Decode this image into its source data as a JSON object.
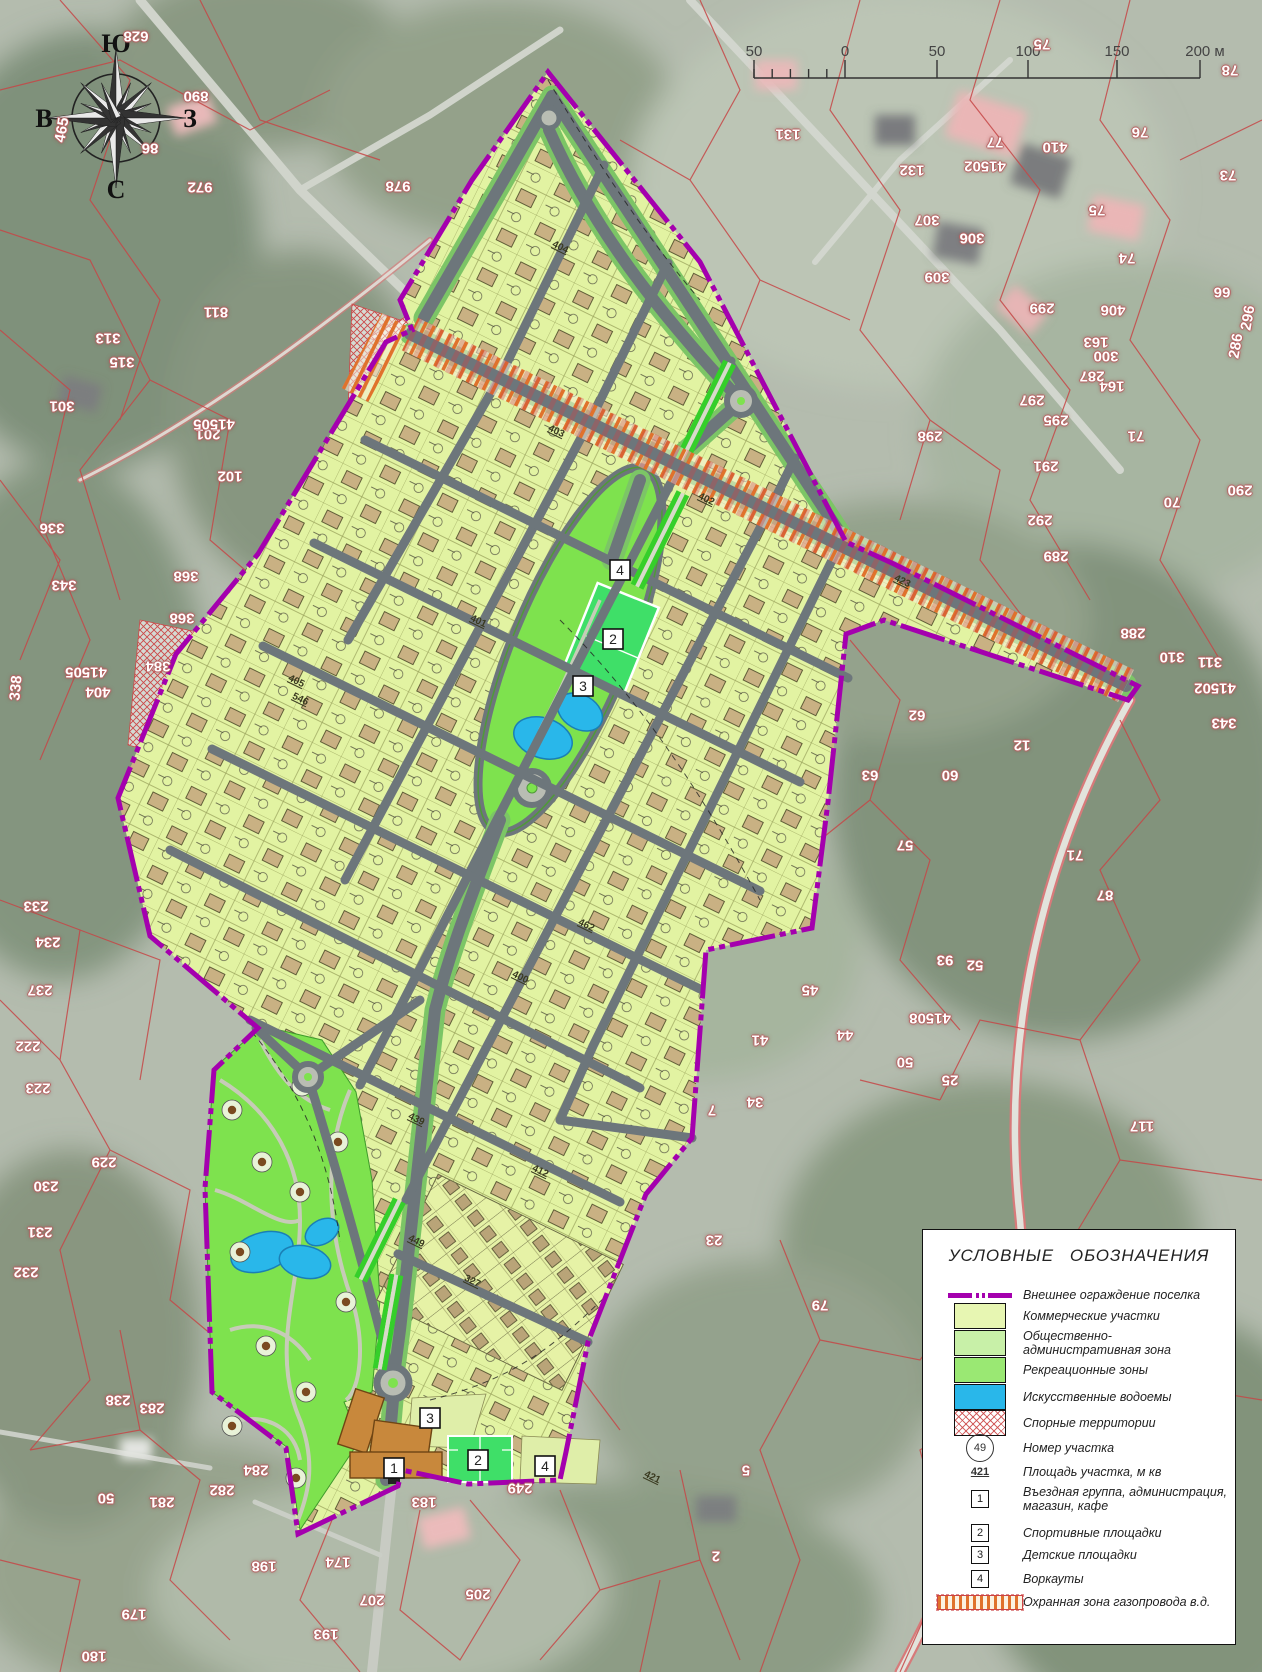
{
  "colors": {
    "boundary_purple": "#a400ae",
    "lot_fill": "#e2f3a2",
    "road_gray": "#6d767b",
    "verge_green": "#7cc566",
    "recreation_green": "#7ee24e",
    "sports_green": "#3fdf68",
    "pond_blue": "#29b7ea",
    "house_tan": "#c9b183",
    "gas_hatch_orange": "#e0722c",
    "disputed_red": "#cc4949",
    "cadastral_red": "#c64747",
    "legend_commercial": "#e7f6b2",
    "legend_admin": "#c8f0a8",
    "legend_recreation": "#9ae873",
    "legend_water": "#29b7ea",
    "admin_building_orange": "#c8883c"
  },
  "compass": {
    "top": "Ю",
    "left": "В",
    "right": "З",
    "bottom": "С"
  },
  "scale_bar": {
    "labels": [
      "50",
      "0",
      "50",
      "100",
      "150",
      "200 м"
    ]
  },
  "legend": {
    "title": "УСЛОВНЫЕ ОБОЗНАЧЕНИЯ",
    "items": [
      {
        "label": "Внешнее ограждение поселка"
      },
      {
        "label": "Коммерческие участки"
      },
      {
        "label": "Общественно-административная зона"
      },
      {
        "label": "Рекреационные зоны"
      },
      {
        "label": "Искусственные водоемы"
      },
      {
        "label": "Спорные территории"
      },
      {
        "label": "Номер участка",
        "symbol": "49"
      },
      {
        "label": "Площадь участка, м кв",
        "symbol": "421"
      },
      {
        "label": "Въездная группа, администрация, магазин, кафе",
        "symbol": "1"
      },
      {
        "label": "Спортивные площадки",
        "symbol": "2"
      },
      {
        "label": "Детские площадки",
        "symbol": "3"
      },
      {
        "label": "Воркауты",
        "symbol": "4"
      },
      {
        "label": "Охранная зона газопровода в.д."
      }
    ]
  },
  "map_markers": [
    {
      "n": "4",
      "x": 620,
      "y": 570
    },
    {
      "n": "2",
      "x": 613,
      "y": 639
    },
    {
      "n": "3",
      "x": 583,
      "y": 686
    },
    {
      "n": "3",
      "x": 430,
      "y": 1418
    },
    {
      "n": "1",
      "x": 394,
      "y": 1468
    },
    {
      "n": "2",
      "x": 478,
      "y": 1460
    },
    {
      "n": "4",
      "x": 545,
      "y": 1466
    }
  ],
  "plan_area_labels": [
    {
      "t": "404",
      "x": 560,
      "y": 248
    },
    {
      "t": "403",
      "x": 556,
      "y": 432
    },
    {
      "t": "401",
      "x": 478,
      "y": 622
    },
    {
      "t": "402",
      "x": 706,
      "y": 500
    },
    {
      "t": "400",
      "x": 520,
      "y": 978
    },
    {
      "t": "405",
      "x": 296,
      "y": 682
    },
    {
      "t": "423",
      "x": 902,
      "y": 582
    },
    {
      "t": "449",
      "x": 416,
      "y": 1242
    },
    {
      "t": "327",
      "x": 472,
      "y": 1282
    },
    {
      "t": "439",
      "x": 416,
      "y": 1120
    },
    {
      "t": "412",
      "x": 540,
      "y": 1172
    },
    {
      "t": "421",
      "x": 652,
      "y": 1478
    },
    {
      "t": "546",
      "x": 300,
      "y": 700
    },
    {
      "t": "462",
      "x": 586,
      "y": 926
    }
  ],
  "cadastral_labels": [
    {
      "t": "628",
      "x": 136,
      "y": 36
    },
    {
      "t": "465",
      "x": 62,
      "y": 130,
      "r": -80
    },
    {
      "t": "890",
      "x": 196,
      "y": 96
    },
    {
      "t": "86",
      "x": 150,
      "y": 148
    },
    {
      "t": "972",
      "x": 200,
      "y": 187
    },
    {
      "t": "978",
      "x": 398,
      "y": 186
    },
    {
      "t": "811",
      "x": 216,
      "y": 312
    },
    {
      "t": "313",
      "x": 108,
      "y": 338
    },
    {
      "t": "315",
      "x": 122,
      "y": 362
    },
    {
      "t": "301",
      "x": 62,
      "y": 406
    },
    {
      "t": "201",
      "x": 208,
      "y": 434
    },
    {
      "t": "41505",
      "x": 214,
      "y": 424
    },
    {
      "t": "102",
      "x": 230,
      "y": 476
    },
    {
      "t": "336",
      "x": 52,
      "y": 528
    },
    {
      "t": "343",
      "x": 64,
      "y": 585
    },
    {
      "t": "368",
      "x": 186,
      "y": 576
    },
    {
      "t": "368",
      "x": 182,
      "y": 618
    },
    {
      "t": "384",
      "x": 158,
      "y": 666
    },
    {
      "t": "338",
      "x": 16,
      "y": 688,
      "r": -85
    },
    {
      "t": "404",
      "x": 98,
      "y": 692
    },
    {
      "t": "41505",
      "x": 86,
      "y": 672
    },
    {
      "t": "233",
      "x": 36,
      "y": 906
    },
    {
      "t": "234",
      "x": 48,
      "y": 942
    },
    {
      "t": "237",
      "x": 40,
      "y": 990
    },
    {
      "t": "222",
      "x": 28,
      "y": 1046
    },
    {
      "t": "223",
      "x": 38,
      "y": 1088
    },
    {
      "t": "229",
      "x": 104,
      "y": 1162
    },
    {
      "t": "230",
      "x": 46,
      "y": 1186
    },
    {
      "t": "231",
      "x": 40,
      "y": 1232
    },
    {
      "t": "232",
      "x": 26,
      "y": 1272
    },
    {
      "t": "238",
      "x": 118,
      "y": 1400
    },
    {
      "t": "283",
      "x": 152,
      "y": 1408
    },
    {
      "t": "50",
      "x": 106,
      "y": 1498
    },
    {
      "t": "281",
      "x": 162,
      "y": 1502
    },
    {
      "t": "282",
      "x": 222,
      "y": 1490
    },
    {
      "t": "284",
      "x": 256,
      "y": 1470
    },
    {
      "t": "183",
      "x": 424,
      "y": 1502
    },
    {
      "t": "249",
      "x": 520,
      "y": 1488
    },
    {
      "t": "198",
      "x": 264,
      "y": 1566
    },
    {
      "t": "174",
      "x": 338,
      "y": 1562
    },
    {
      "t": "179",
      "x": 134,
      "y": 1614
    },
    {
      "t": "180",
      "x": 94,
      "y": 1656
    },
    {
      "t": "193",
      "x": 326,
      "y": 1634
    },
    {
      "t": "205",
      "x": 478,
      "y": 1594
    },
    {
      "t": "207",
      "x": 372,
      "y": 1600
    },
    {
      "t": "76",
      "x": 1140,
      "y": 132
    },
    {
      "t": "77",
      "x": 995,
      "y": 142
    },
    {
      "t": "41502",
      "x": 985,
      "y": 166
    },
    {
      "t": "410",
      "x": 1055,
      "y": 147
    },
    {
      "t": "73",
      "x": 1228,
      "y": 175
    },
    {
      "t": "75",
      "x": 1097,
      "y": 210
    },
    {
      "t": "74",
      "x": 1127,
      "y": 258
    },
    {
      "t": "299",
      "x": 1042,
      "y": 308
    },
    {
      "t": "406",
      "x": 1113,
      "y": 310
    },
    {
      "t": "66",
      "x": 1222,
      "y": 292
    },
    {
      "t": "307",
      "x": 927,
      "y": 220
    },
    {
      "t": "306",
      "x": 972,
      "y": 238
    },
    {
      "t": "309",
      "x": 937,
      "y": 277
    },
    {
      "t": "131",
      "x": 788,
      "y": 134
    },
    {
      "t": "132",
      "x": 912,
      "y": 170
    },
    {
      "t": "78",
      "x": 1230,
      "y": 70
    },
    {
      "t": "75",
      "x": 1042,
      "y": 44
    },
    {
      "t": "163",
      "x": 1096,
      "y": 342
    },
    {
      "t": "164",
      "x": 1112,
      "y": 386
    },
    {
      "t": "295",
      "x": 1056,
      "y": 420
    },
    {
      "t": "297",
      "x": 1032,
      "y": 400
    },
    {
      "t": "287",
      "x": 1092,
      "y": 376
    },
    {
      "t": "300",
      "x": 1106,
      "y": 356
    },
    {
      "t": "286",
      "x": 1236,
      "y": 346,
      "r": -80
    },
    {
      "t": "296",
      "x": 1248,
      "y": 318,
      "r": -80
    },
    {
      "t": "298",
      "x": 930,
      "y": 436
    },
    {
      "t": "291",
      "x": 1046,
      "y": 466
    },
    {
      "t": "71",
      "x": 1136,
      "y": 436
    },
    {
      "t": "70",
      "x": 1172,
      "y": 502
    },
    {
      "t": "292",
      "x": 1040,
      "y": 520
    },
    {
      "t": "289",
      "x": 1056,
      "y": 556
    },
    {
      "t": "290",
      "x": 1240,
      "y": 490
    },
    {
      "t": "288",
      "x": 1133,
      "y": 633
    },
    {
      "t": "310",
      "x": 1172,
      "y": 657
    },
    {
      "t": "311",
      "x": 1210,
      "y": 662
    },
    {
      "t": "41502",
      "x": 1215,
      "y": 688
    },
    {
      "t": "343",
      "x": 1224,
      "y": 723
    },
    {
      "t": "12",
      "x": 1022,
      "y": 745
    },
    {
      "t": "62",
      "x": 917,
      "y": 715
    },
    {
      "t": "63",
      "x": 870,
      "y": 775
    },
    {
      "t": "60",
      "x": 950,
      "y": 775
    },
    {
      "t": "57",
      "x": 905,
      "y": 845
    },
    {
      "t": "71",
      "x": 1075,
      "y": 855
    },
    {
      "t": "87",
      "x": 1105,
      "y": 895
    },
    {
      "t": "93",
      "x": 945,
      "y": 960
    },
    {
      "t": "52",
      "x": 975,
      "y": 965
    },
    {
      "t": "45",
      "x": 810,
      "y": 990
    },
    {
      "t": "41508",
      "x": 930,
      "y": 1018
    },
    {
      "t": "34",
      "x": 755,
      "y": 1102
    },
    {
      "t": "44",
      "x": 845,
      "y": 1035
    },
    {
      "t": "41",
      "x": 760,
      "y": 1040
    },
    {
      "t": "50",
      "x": 905,
      "y": 1062
    },
    {
      "t": "25",
      "x": 950,
      "y": 1080
    },
    {
      "t": "7",
      "x": 712,
      "y": 1110
    },
    {
      "t": "117",
      "x": 1142,
      "y": 1126
    },
    {
      "t": "23",
      "x": 714,
      "y": 1240
    },
    {
      "t": "79",
      "x": 820,
      "y": 1305
    },
    {
      "t": "5",
      "x": 746,
      "y": 1470
    },
    {
      "t": "2",
      "x": 716,
      "y": 1556
    }
  ]
}
